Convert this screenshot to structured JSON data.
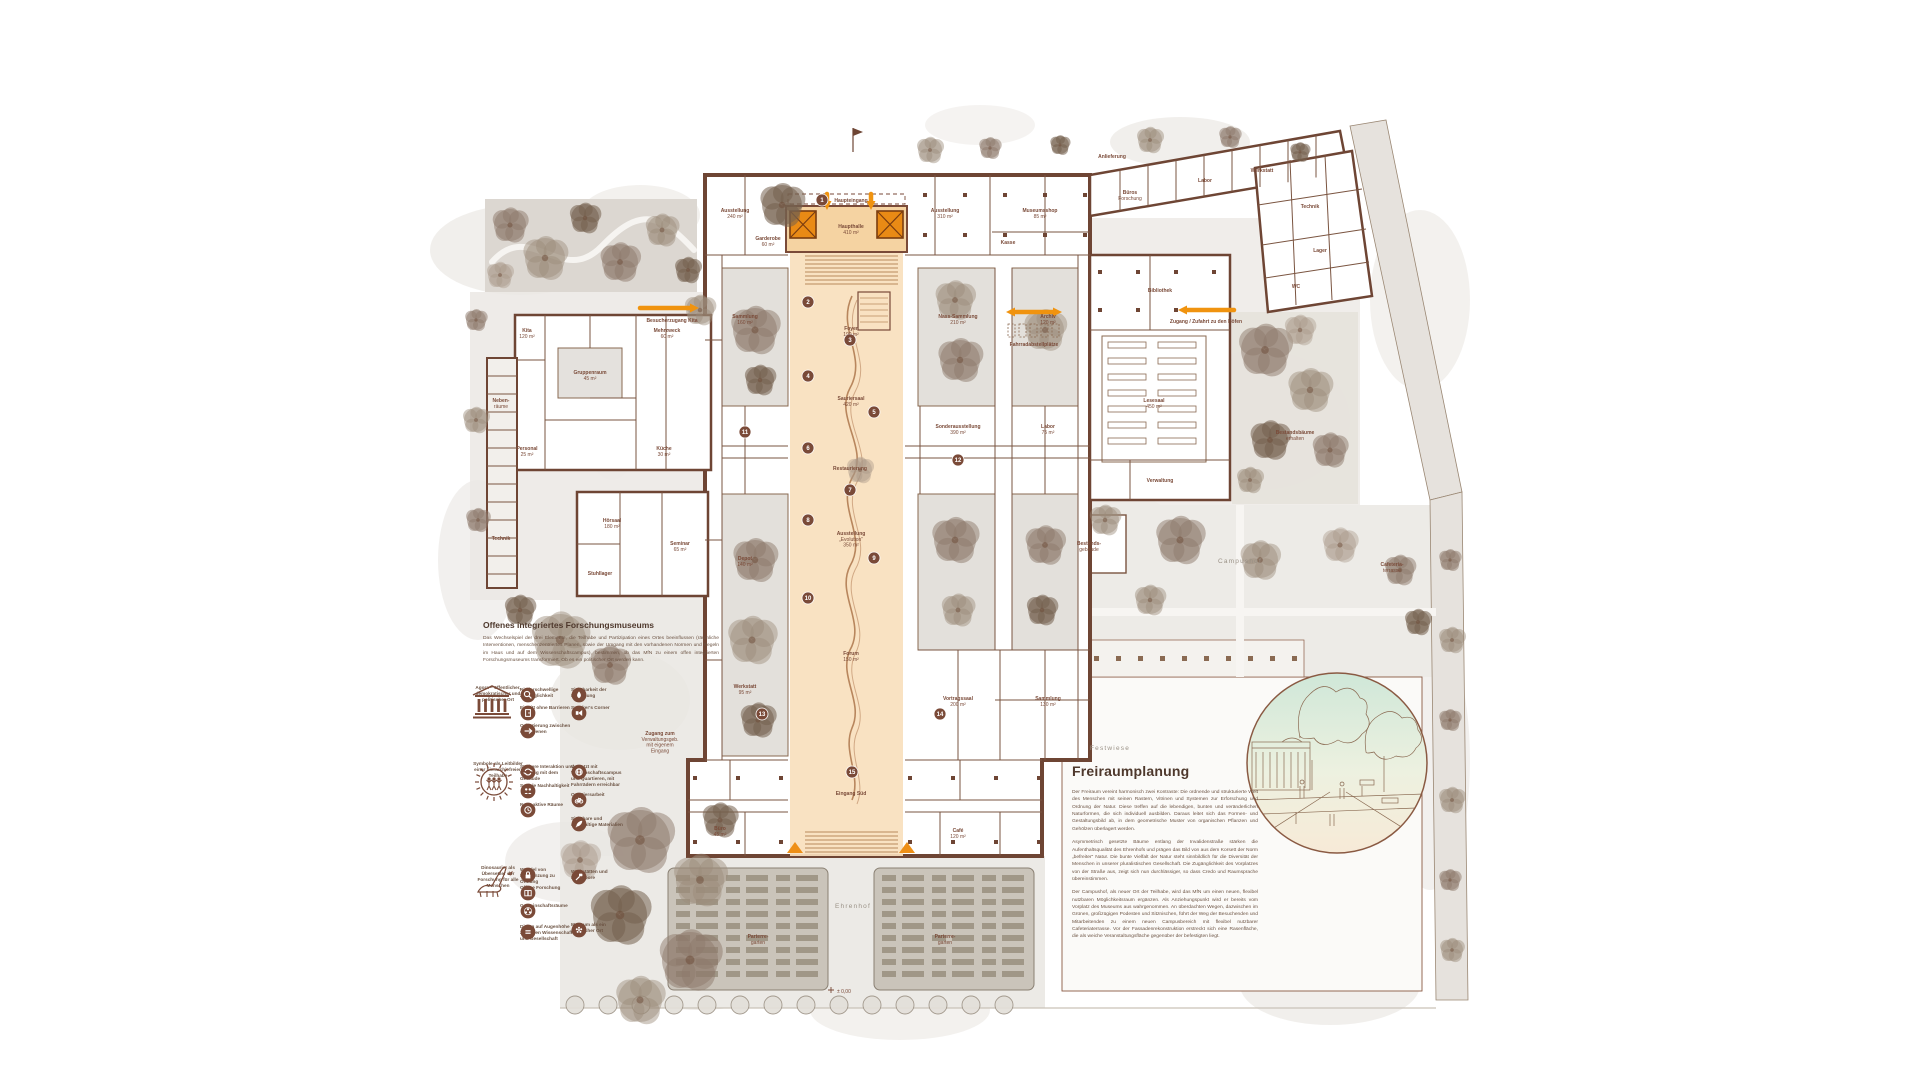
{
  "colors": {
    "orange": "#ee8f16",
    "orange_dark": "#7a3c10",
    "peach": "#f8dfbd",
    "peach_dark": "#f5d3a2",
    "wall": "#6e4534",
    "wall_light": "#8a6a52",
    "text_brown": "#7a4a38",
    "court": "#e3e0db",
    "garden": "#dcd7d1",
    "plaza_white": "#fbfaf8",
    "zone_label": "#9a9186",
    "vignette_top": "#cfe7d8",
    "vignette_mid": "#edf1e0",
    "vignette_bottom": "#f7ead7"
  },
  "left_text": {
    "title": "Offenes integriertes Forschungsmuseums",
    "body": "Das Wechselspiel der drei Elemente, die Teilhabe und Partizipation eines Ortes beeinflussen (räumliche Interventionen, menschenzentriertes Planen, sowie der Umgang mit den vorhandenen Normen und Regeln im Haus und auf dem Wissenschaftscampus), bestimmen, ob das MfN zu einem offen integrierten Forschungsmuseums transformiert. Ob es ein politischer Ort werden kann."
  },
  "freiraumplanung": {
    "title": "Freiraumplanung",
    "paragraphs": [
      "Der Freiraum vereint harmonisch zwei Kontraste: Die ordnende und strukturierte Welt des Menschen mit seinen Rastern, Vitrinen und Systemen zur Erforschung und Ordnung der Natur. Diese treffen auf die lebendigen, bunten und veränderlichen Naturformen, die sich individuell ausbilden. Daraus leitet sich das Formen- und Gestaltungsbild ab, in dem geometrische Muster von organischen Pflanzen und Gehölzen überlagert werden.",
      "Asymmetrisch gesetzte Bäume entlang der Invalidenstraße stärken die Aufenthaltsqualität des Ehrenhofs und prägen das Bild von aus dem Korsett der Norm „befreiter“ Natur. Die bunte Vielfalt der Natur steht sinnbildlich für die Diversität der Menschen in unserer pluralistischen Gesellschaft. Die Zugänglichkeit des Vorplatzes von der Straße aus, zeigt sich nun durchlässiger, so dass Credo und Raumsprache übereinstimmen.",
      "Der Campushof, als neuer Ort der Teilhabe, wird das MfN um einen neuen, flexibel nutzbaren Möglichkeitsraum ergänzen. Als Anziehungspunkt wird er bereits vom Vorplatz des Museums aus wahrgenommen. An überdachten Wegen, dazwischen im Grünen, großzügigen Podesten und Sitznischen, führt der Weg der Besuchenden und Mitarbeitenden zu einem neuen Campusbereich mit flexibel nutzbarer Cafeteriaterrasse. Vor der Fassadenrekonstruktion erstreckt sich eine Rasenfläche, die als weiche Veranstaltungsfläche gegenüber der befestigten liegt."
    ]
  },
  "legend": {
    "pillars": [
      {
        "icon": "temple-icon",
        "caption": "Agora – öffentlicher, demokratischer und politischer Ort"
      },
      {
        "icon": "sun-people-icon",
        "caption": "Symbole als Leitbilder einer hierarchiefreien Teilhabe"
      },
      {
        "icon": "dinosaur-icon",
        "caption": "Dinosaurier als Übersetzer der Forschung für alle Menschen"
      }
    ],
    "groups": [
      {
        "items": [
          {
            "col": 2,
            "icon": "magnifier-icon",
            "label": "Niederschwellige Zugänglichkeit"
          },
          {
            "col": 2,
            "icon": "door-icon",
            "label": "Eintritt ohne Barrieren"
          },
          {
            "col": 2,
            "icon": "signpost-icon",
            "label": "Orientierung zwischen den Ebenen"
          },
          {
            "col": 3,
            "icon": "droplet-icon",
            "label": "Sichtbarkeit der Forschung"
          },
          {
            "col": 3,
            "icon": "speaker-icon",
            "label": "Speaker's Corner"
          }
        ]
      },
      {
        "items": [
          {
            "col": 2,
            "icon": "interaction-icon",
            "label": "Stärkere Interaktion und Umgang mit dem Gebäude"
          },
          {
            "col": 2,
            "icon": "people-icon",
            "label": "Soziale Nachhaltigkeit"
          },
          {
            "col": 2,
            "icon": "clock-icon",
            "label": "Neue aktive Räume"
          },
          {
            "col": 3,
            "icon": "network-icon",
            "label": "Vernetzt mit Wissenschaftscampus und Quartieren, mit Fahrrädern erreichbar"
          },
          {
            "col": 3,
            "icon": "bike-icon",
            "label": "Quartiersarbeit"
          },
          {
            "col": 3,
            "icon": "leaf-icon",
            "label": "Sichtbare und nachhaltige Materialien"
          }
        ]
      },
      {
        "items": [
          {
            "col": 2,
            "icon": "lock-icon",
            "label": "Wandel von Eingrenzung zu Öffnung"
          },
          {
            "col": 2,
            "icon": "book-icon",
            "label": "Offene Forschung"
          },
          {
            "col": 2,
            "icon": "community-icon",
            "label": "Gemeinschaftsräume"
          },
          {
            "col": 2,
            "icon": "dialog-icon",
            "label": "Dialog auf Augenhöhe zwischen Wissenschaft und Gesellschaft"
          },
          {
            "col": 3,
            "icon": "workshop-icon",
            "label": "Werkstätten und Reallabore"
          },
          {
            "col": 3,
            "icon": "flower-icon",
            "label": "Museum als ein politischer Ort"
          }
        ]
      }
    ]
  },
  "arrows": [
    {
      "x1": 640,
      "y1": 308,
      "x2": 699,
      "y2": 308,
      "heads": "end",
      "label": "Besucherzugang Kita",
      "lx": 672,
      "ly": 322
    },
    {
      "x1": 1006,
      "y1": 312,
      "x2": 1062,
      "y2": 312,
      "heads": "both",
      "label": "Fahrradabstellplätze",
      "lx": 1034,
      "ly": 346
    },
    {
      "x1": 1234,
      "y1": 310,
      "x2": 1178,
      "y2": 310,
      "heads": "end",
      "label": "Zugang / Zufahrt zu den Höfen",
      "lx": 1206,
      "ly": 323
    },
    {
      "x1": 827,
      "y1": 194,
      "x2": 827,
      "y2": 210,
      "heads": "end",
      "label": "",
      "lx": 0,
      "ly": 0
    },
    {
      "x1": 871,
      "y1": 194,
      "x2": 871,
      "y2": 210,
      "heads": "end",
      "label": "",
      "lx": 0,
      "ly": 0
    }
  ],
  "plan": {
    "level_marker": "± 0,00",
    "zone_labels": [
      {
        "x": 1240,
        "y": 563,
        "text": "Campushof"
      },
      {
        "x": 1110,
        "y": 750,
        "text": "Festwiese"
      },
      {
        "x": 853,
        "y": 908,
        "text": "Ehrenhof"
      }
    ],
    "room_labels": [
      {
        "x": 527,
        "y": 332,
        "l": [
          "Kita",
          "120 m²"
        ]
      },
      {
        "x": 667,
        "y": 332,
        "l": [
          "Mehrzweck",
          "60 m²"
        ]
      },
      {
        "x": 590,
        "y": 374,
        "l": [
          "Gruppenraum",
          "45 m²"
        ]
      },
      {
        "x": 527,
        "y": 450,
        "l": [
          "Personal",
          "25 m²"
        ]
      },
      {
        "x": 664,
        "y": 450,
        "l": [
          "Küche",
          "30 m²"
        ]
      },
      {
        "x": 501,
        "y": 402,
        "l": [
          "Neben-",
          "räume"
        ]
      },
      {
        "x": 501,
        "y": 540,
        "l": [
          "Technik"
        ]
      },
      {
        "x": 612,
        "y": 522,
        "l": [
          "Hörsaal",
          "180 m²"
        ]
      },
      {
        "x": 680,
        "y": 545,
        "l": [
          "Seminar",
          "65 m²"
        ]
      },
      {
        "x": 600,
        "y": 575,
        "l": [
          "Stuhllager"
        ]
      },
      {
        "x": 660,
        "y": 735,
        "l": [
          "Zugang zum",
          "Verwaltungsgeb.",
          "mit eigenem",
          "Eingang"
        ]
      },
      {
        "x": 735,
        "y": 212,
        "l": [
          "Ausstellung",
          "240 m²"
        ]
      },
      {
        "x": 768,
        "y": 240,
        "l": [
          "Garderobe",
          "60 m²"
        ]
      },
      {
        "x": 851,
        "y": 202,
        "l": [
          "Haupteingang"
        ]
      },
      {
        "x": 945,
        "y": 212,
        "l": [
          "Ausstellung",
          "310 m²"
        ]
      },
      {
        "x": 1040,
        "y": 212,
        "l": [
          "Museumsshop",
          "85 m²"
        ]
      },
      {
        "x": 1008,
        "y": 244,
        "l": [
          "Kasse"
        ]
      },
      {
        "x": 851,
        "y": 228,
        "l": [
          "Haupthalle",
          "410 m²"
        ]
      },
      {
        "x": 851,
        "y": 330,
        "l": [
          "Foyer",
          "190 m²"
        ]
      },
      {
        "x": 851,
        "y": 400,
        "l": [
          "Sauriersaal",
          "420 m²"
        ]
      },
      {
        "x": 851,
        "y": 535,
        "l": [
          "Ausstellung",
          "„Evolution“",
          "350 m²"
        ]
      },
      {
        "x": 851,
        "y": 655,
        "l": [
          "Forum",
          "150 m²"
        ]
      },
      {
        "x": 851,
        "y": 795,
        "l": [
          "Eingang Süd"
        ]
      },
      {
        "x": 745,
        "y": 318,
        "l": [
          "Sammlung",
          "160 m²"
        ]
      },
      {
        "x": 745,
        "y": 560,
        "l": [
          "Depot",
          "140 m²"
        ]
      },
      {
        "x": 745,
        "y": 688,
        "l": [
          "Werkstatt",
          "95 m²"
        ]
      },
      {
        "x": 720,
        "y": 830,
        "l": [
          "Büro",
          "45 m²"
        ]
      },
      {
        "x": 958,
        "y": 318,
        "l": [
          "Nass-Sammlung",
          "210 m²"
        ]
      },
      {
        "x": 1048,
        "y": 318,
        "l": [
          "Archiv",
          "120 m²"
        ]
      },
      {
        "x": 850,
        "y": 470,
        "l": [
          "Restaurierung"
        ]
      },
      {
        "x": 958,
        "y": 428,
        "l": [
          "Sonderausstellung",
          "390 m²"
        ]
      },
      {
        "x": 1048,
        "y": 428,
        "l": [
          "Labor",
          "75 m²"
        ]
      },
      {
        "x": 958,
        "y": 700,
        "l": [
          "Vortragssaal",
          "200 m²"
        ]
      },
      {
        "x": 1048,
        "y": 700,
        "l": [
          "Sammlung",
          "130 m²"
        ]
      },
      {
        "x": 958,
        "y": 832,
        "l": [
          "Café",
          "120 m²"
        ]
      },
      {
        "x": 1160,
        "y": 292,
        "l": [
          "Bibliothek"
        ]
      },
      {
        "x": 1154,
        "y": 402,
        "l": [
          "Lesesaal",
          "450 m²"
        ]
      },
      {
        "x": 1160,
        "y": 482,
        "l": [
          "Verwaltung"
        ]
      },
      {
        "x": 1130,
        "y": 194,
        "l": [
          "Büros",
          "Forschung"
        ]
      },
      {
        "x": 1205,
        "y": 182,
        "l": [
          "Labor"
        ]
      },
      {
        "x": 1262,
        "y": 172,
        "l": [
          "Werkstatt"
        ]
      },
      {
        "x": 1310,
        "y": 208,
        "l": [
          "Technik"
        ]
      },
      {
        "x": 1320,
        "y": 252,
        "l": [
          "Lager"
        ]
      },
      {
        "x": 1296,
        "y": 288,
        "l": [
          "WC"
        ]
      },
      {
        "x": 1112,
        "y": 158,
        "l": [
          "Anlieferung"
        ]
      },
      {
        "x": 1295,
        "y": 434,
        "l": [
          "Bestandsbäume",
          "erhalten"
        ]
      },
      {
        "x": 1392,
        "y": 566,
        "l": [
          "Cafeteria-",
          "terrasse"
        ]
      },
      {
        "x": 1089,
        "y": 545,
        "l": [
          "Bestands-",
          "gebäude"
        ]
      },
      {
        "x": 758,
        "y": 938,
        "l": [
          "Parterre-",
          "garten"
        ]
      },
      {
        "x": 945,
        "y": 938,
        "l": [
          "Parterre-",
          "garten"
        ]
      }
    ],
    "markers": [
      {
        "x": 822,
        "y": 200,
        "n": "1"
      },
      {
        "x": 808,
        "y": 302,
        "n": "2"
      },
      {
        "x": 850,
        "y": 340,
        "n": "3"
      },
      {
        "x": 808,
        "y": 376,
        "n": "4"
      },
      {
        "x": 874,
        "y": 412,
        "n": "5"
      },
      {
        "x": 808,
        "y": 448,
        "n": "6"
      },
      {
        "x": 850,
        "y": 490,
        "n": "7"
      },
      {
        "x": 808,
        "y": 520,
        "n": "8"
      },
      {
        "x": 874,
        "y": 558,
        "n": "9"
      },
      {
        "x": 808,
        "y": 598,
        "n": "10"
      },
      {
        "x": 745,
        "y": 432,
        "n": "11"
      },
      {
        "x": 958,
        "y": 460,
        "n": "12"
      },
      {
        "x": 762,
        "y": 714,
        "n": "13"
      },
      {
        "x": 940,
        "y": 714,
        "n": "14"
      },
      {
        "x": 852,
        "y": 772,
        "n": "15"
      }
    ]
  }
}
